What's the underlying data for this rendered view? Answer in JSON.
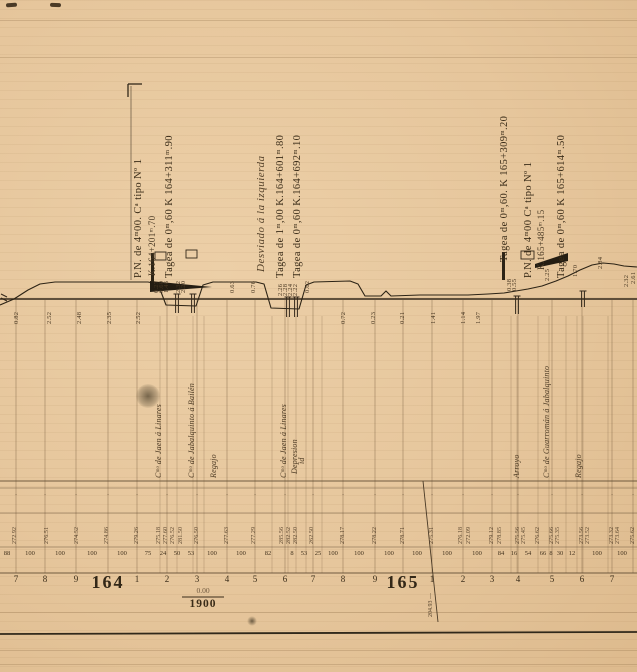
{
  "colors": {
    "paper": "#e6c69c",
    "ink": "#33281a",
    "grid": "#7b6142",
    "table_line": "#5d4930",
    "stain": "#3b311f"
  },
  "annotations": {
    "left_pn": {
      "line1": "P.N. de 4ᵐ00. Cᵃ tipo Nº 1",
      "line2": "K.164+201ᵐ.70",
      "line3": "Tagea de 0ᵐ,60  K 164+311ᵐ.90"
    },
    "middle": {
      "line1": "Desviado á la izquierda",
      "line2": "Tagea de 1ᵐ,00  K.164+601ᵐ.80",
      "line3": "Tagea de 0ᵐ,60  K.164+692ᵐ.10"
    },
    "right": {
      "line1": "Tagea de 0ᵐ,60. K 165+309ᵐ.20",
      "line2": "P.N. de 4ᵐ00  Cᵃ tipo Nº 1",
      "line3": "K.165+485ᵐ.15",
      "line4": "Tagea de 0ᵐ,60  K 165+614ᵐ.50"
    }
  },
  "gradient_mark": {
    "top": "0.00",
    "bottom": "1900"
  },
  "diagonal_label": "204.93 —",
  "road_labels": [
    {
      "x": 155,
      "y": 478,
      "text": "Cᵐᵒ de Jaen á Linares"
    },
    {
      "x": 188,
      "y": 478,
      "text": "Cᵐᵒ de Jabalquinto á Bailén"
    },
    {
      "x": 210,
      "y": 478,
      "text": "Regajo"
    },
    {
      "x": 280,
      "y": 478,
      "text": "Cᵐᵒ de Jaen á Linares"
    },
    {
      "x": 291,
      "y": 474,
      "text": "Depresion"
    },
    {
      "x": 298,
      "y": 464,
      "text": "id"
    },
    {
      "x": 513,
      "y": 478,
      "text": "Arroyo"
    },
    {
      "x": 543,
      "y": 478,
      "text": "Cᵐᵒ de Guarromán á Jabalquinto"
    },
    {
      "x": 575,
      "y": 478,
      "text": "Regajo"
    }
  ],
  "heights": [
    {
      "x": 14,
      "y": 324,
      "v": "0.82"
    },
    {
      "x": 47,
      "y": 324,
      "v": "2.52"
    },
    {
      "x": 77,
      "y": 324,
      "v": "2.48"
    },
    {
      "x": 107,
      "y": 324,
      "v": "2.35"
    },
    {
      "x": 136,
      "y": 324,
      "v": "2.52"
    },
    {
      "x": 154,
      "y": 293,
      "v": "0.27"
    },
    {
      "x": 159,
      "y": 293,
      "v": "0.60"
    },
    {
      "x": 164,
      "y": 293,
      "v": "1.46"
    },
    {
      "x": 176,
      "y": 293,
      "v": "2.32"
    },
    {
      "x": 181,
      "y": 293,
      "v": "2.20"
    },
    {
      "x": 230,
      "y": 293,
      "v": "0.63"
    },
    {
      "x": 251,
      "y": 293,
      "v": "0.76"
    },
    {
      "x": 278,
      "y": 296,
      "v": "2.26"
    },
    {
      "x": 283,
      "y": 296,
      "v": "2.28"
    },
    {
      "x": 288,
      "y": 296,
      "v": "2.24"
    },
    {
      "x": 293,
      "y": 296,
      "v": "2.22"
    },
    {
      "x": 305,
      "y": 293,
      "v": "0.62"
    },
    {
      "x": 341,
      "y": 324,
      "v": "0.72"
    },
    {
      "x": 371,
      "y": 324,
      "v": "0.23"
    },
    {
      "x": 400,
      "y": 324,
      "v": "0.21"
    },
    {
      "x": 431,
      "y": 324,
      "v": "1.41"
    },
    {
      "x": 461,
      "y": 324,
      "v": "1.14"
    },
    {
      "x": 476,
      "y": 324,
      "v": "1.97"
    },
    {
      "x": 507,
      "y": 291,
      "v": "0.38"
    },
    {
      "x": 512,
      "y": 291,
      "v": "0.55"
    },
    {
      "x": 545,
      "y": 281,
      "v": "2.25"
    },
    {
      "x": 573,
      "y": 277,
      "v": "1.70"
    },
    {
      "x": 598,
      "y": 269,
      "v": "2.84"
    },
    {
      "x": 624,
      "y": 287,
      "v": "2.32"
    },
    {
      "x": 631,
      "y": 284,
      "v": "2.61"
    }
  ],
  "table": {
    "elevations": [
      {
        "x": 12,
        "v": "272.92"
      },
      {
        "x": 44,
        "v": "276.51"
      },
      {
        "x": 74,
        "v": "274.52"
      },
      {
        "x": 104,
        "v": "274.86"
      },
      {
        "x": 134,
        "v": "279.26"
      },
      {
        "x": 156,
        "v": "275.18"
      },
      {
        "x": 163,
        "v": "277.60"
      },
      {
        "x": 170,
        "v": "276.52"
      },
      {
        "x": 178,
        "v": "281.50"
      },
      {
        "x": 194,
        "v": "276.50"
      },
      {
        "x": 224,
        "v": "277.63"
      },
      {
        "x": 251,
        "v": "277.29"
      },
      {
        "x": 279,
        "v": "285.56"
      },
      {
        "x": 286,
        "v": "282.52"
      },
      {
        "x": 293,
        "v": "282.50"
      },
      {
        "x": 309,
        "v": "262.50"
      },
      {
        "x": 340,
        "v": "278.17"
      },
      {
        "x": 372,
        "v": "278.22"
      },
      {
        "x": 400,
        "v": "278.71"
      },
      {
        "x": 429,
        "v": "275.31"
      },
      {
        "x": 458,
        "v": "276.18"
      },
      {
        "x": 466,
        "v": "272.09"
      },
      {
        "x": 489,
        "v": "279.12"
      },
      {
        "x": 497,
        "v": "278.85"
      },
      {
        "x": 515,
        "v": "275.56"
      },
      {
        "x": 521,
        "v": "275.45"
      },
      {
        "x": 535,
        "v": "276.62"
      },
      {
        "x": 549,
        "v": "275.66"
      },
      {
        "x": 555,
        "v": "275.35"
      },
      {
        "x": 579,
        "v": "273.56"
      },
      {
        "x": 585,
        "v": "273.52"
      },
      {
        "x": 609,
        "v": "273.32"
      },
      {
        "x": 615,
        "v": "273.64"
      },
      {
        "x": 630,
        "v": "275.62"
      }
    ],
    "distances": [
      {
        "x": 7,
        "v": "88"
      },
      {
        "x": 30,
        "v": "100"
      },
      {
        "x": 60,
        "v": "100"
      },
      {
        "x": 92,
        "v": "100"
      },
      {
        "x": 122,
        "v": "100"
      },
      {
        "x": 148,
        "v": "75"
      },
      {
        "x": 163,
        "v": "24"
      },
      {
        "x": 177,
        "v": "50"
      },
      {
        "x": 191,
        "v": "53"
      },
      {
        "x": 212,
        "v": "100"
      },
      {
        "x": 241,
        "v": "100"
      },
      {
        "x": 268,
        "v": "82"
      },
      {
        "x": 292,
        "v": "8"
      },
      {
        "x": 304,
        "v": "53"
      },
      {
        "x": 318,
        "v": "25"
      },
      {
        "x": 333,
        "v": "100"
      },
      {
        "x": 359,
        "v": "100"
      },
      {
        "x": 389,
        "v": "100"
      },
      {
        "x": 417,
        "v": "100"
      },
      {
        "x": 447,
        "v": "100"
      },
      {
        "x": 477,
        "v": "100"
      },
      {
        "x": 501,
        "v": "84"
      },
      {
        "x": 514,
        "v": "16"
      },
      {
        "x": 528,
        "v": "54"
      },
      {
        "x": 543,
        "v": "66"
      },
      {
        "x": 551,
        "v": "8"
      },
      {
        "x": 560,
        "v": "30"
      },
      {
        "x": 572,
        "v": "12"
      },
      {
        "x": 597,
        "v": "100"
      },
      {
        "x": 622,
        "v": "100"
      }
    ],
    "hectometres": [
      {
        "x": 16,
        "label": "7"
      },
      {
        "x": 45,
        "label": "8"
      },
      {
        "x": 76,
        "label": "9"
      },
      {
        "x": 108,
        "label": "164",
        "big": true
      },
      {
        "x": 137,
        "label": "1"
      },
      {
        "x": 167,
        "label": "2"
      },
      {
        "x": 197,
        "label": "3"
      },
      {
        "x": 227,
        "label": "4"
      },
      {
        "x": 255,
        "label": "5"
      },
      {
        "x": 285,
        "label": "6"
      },
      {
        "x": 313,
        "label": "7"
      },
      {
        "x": 343,
        "label": "8"
      },
      {
        "x": 375,
        "label": "9"
      },
      {
        "x": 403,
        "label": "165",
        "big": true
      },
      {
        "x": 432,
        "label": "1"
      },
      {
        "x": 463,
        "label": "2"
      },
      {
        "x": 492,
        "label": "3"
      },
      {
        "x": 518,
        "label": "4"
      },
      {
        "x": 552,
        "label": "5"
      },
      {
        "x": 582,
        "label": "6"
      },
      {
        "x": 612,
        "label": "7"
      }
    ],
    "tick_glyph": "·"
  },
  "profile": {
    "datum_y": 299,
    "terrain": [
      [
        0,
        305
      ],
      [
        14,
        299
      ],
      [
        28,
        290
      ],
      [
        40,
        284
      ],
      [
        55,
        282
      ],
      [
        148,
        282
      ],
      [
        158,
        284
      ],
      [
        166,
        305
      ],
      [
        196,
        306
      ],
      [
        203,
        285
      ],
      [
        213,
        282
      ],
      [
        256,
        282
      ],
      [
        264,
        284
      ],
      [
        271,
        308
      ],
      [
        299,
        309
      ],
      [
        306,
        285
      ],
      [
        314,
        282
      ],
      [
        350,
        281
      ],
      [
        358,
        284
      ],
      [
        365,
        296
      ],
      [
        381,
        296
      ],
      [
        386,
        291
      ],
      [
        391,
        296
      ],
      [
        420,
        295
      ],
      [
        468,
        295
      ],
      [
        488,
        294
      ],
      [
        504,
        293
      ],
      [
        516,
        291
      ],
      [
        528,
        289
      ],
      [
        542,
        286
      ],
      [
        556,
        281
      ],
      [
        568,
        276
      ],
      [
        580,
        270
      ],
      [
        592,
        265
      ],
      [
        603,
        263
      ],
      [
        614,
        264
      ],
      [
        624,
        266
      ],
      [
        637,
        267
      ]
    ],
    "main_verticals": [
      16,
      45,
      76,
      108,
      137,
      167,
      197,
      227,
      255,
      285,
      313,
      343,
      375,
      403,
      432,
      463,
      492,
      518,
      552,
      582,
      612,
      633
    ],
    "sub_verticals": [
      160,
      177,
      193,
      204,
      272,
      288,
      296,
      306,
      322,
      511,
      517,
      538,
      549,
      566,
      577,
      583,
      608
    ],
    "culverts": [
      {
        "x": 177,
        "y1": 294,
        "y2": 313
      },
      {
        "x": 193,
        "y1": 294,
        "y2": 313
      },
      {
        "x": 288,
        "y1": 297,
        "y2": 317
      },
      {
        "x": 296,
        "y1": 297,
        "y2": 317
      },
      {
        "x": 517,
        "y1": 296,
        "y2": 314
      },
      {
        "x": 583,
        "y1": 291,
        "y2": 307
      }
    ],
    "wedges": [
      "150,281 212,287 150,292",
      "535,264 568,253 568,261 535,268"
    ],
    "marker_bars": [
      {
        "x": 151,
        "y": 253,
        "w": 3,
        "h": 29
      },
      {
        "x": 502,
        "y": 252,
        "w": 3,
        "h": 28
      }
    ],
    "plan_rects": [
      {
        "x": 155,
        "y": 252,
        "w": 11,
        "h": 8
      },
      {
        "x": 186,
        "y": 250,
        "w": 11,
        "h": 8
      },
      {
        "x": 521,
        "y": 251,
        "w": 13,
        "h": 8
      }
    ],
    "bracket": {
      "x": 128,
      "y": 84,
      "arm": 14,
      "drop": 13,
      "stem_to": 280
    },
    "diagonal": {
      "x1": 423,
      "y1": 481,
      "x2": 438,
      "y2": 622
    },
    "table_lines_y": [
      481,
      488,
      513,
      547,
      573
    ],
    "fraction_bar": {
      "x1": 182,
      "x2": 224,
      "y": 597
    },
    "bottom_rule_y": 633
  }
}
